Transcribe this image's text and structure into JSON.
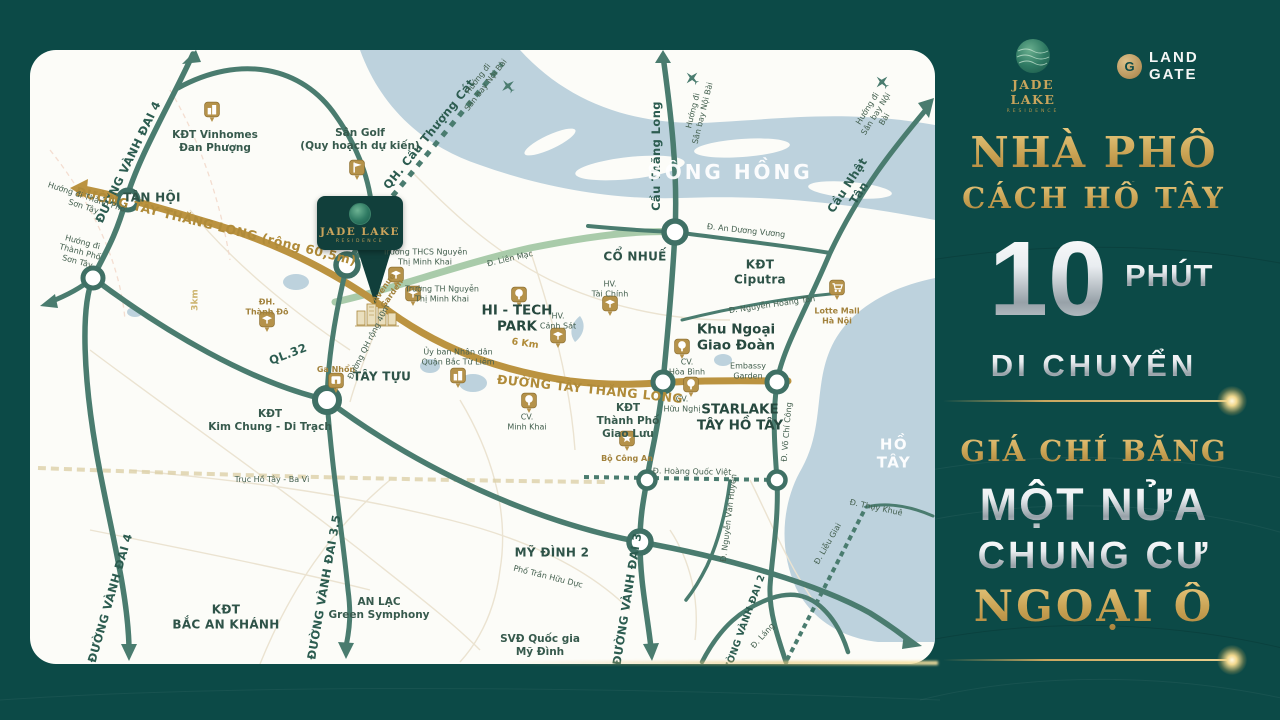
{
  "panel": {
    "jade_lake": {
      "title": "JADE LAKE",
      "subtitle": "RESIDENCE"
    },
    "land_gate": {
      "line1": "LAND",
      "line2": "GATE"
    },
    "headline_line1": "NHÀ PHỐ",
    "headline_line2": "CÁCH HỒ TÂY",
    "big_number": "10",
    "big_number_unit": "PHÚT",
    "headline_line3": "DI CHUYỂN",
    "sub_line1": "GIÁ CHỈ BẰNG",
    "sub_line2": "MỘT NỬA",
    "sub_line3": "CHUNG CƯ",
    "sub_line4": "NGOẠI Ô",
    "colors": {
      "background": "#0c4a47",
      "gold": "#c8a45c",
      "silver": "#e6ebee"
    }
  },
  "map": {
    "pin": {
      "title": "JADE LAKE",
      "subtitle": "RESIDENCE"
    },
    "colors": {
      "water": "#bdd2dd",
      "road_green": "#4a7c6f",
      "road_gold": "#bb9340",
      "road_light_green": "#a9cbaa"
    },
    "labels": [
      {
        "name": "road-vanh-dai-4-north",
        "text": "ĐƯỜNG VÀNH ĐAI 4",
        "x": 98,
        "y": 112,
        "rot": -64,
        "cls": "l-road"
      },
      {
        "name": "road-vanh-dai-4-south",
        "text": "ĐƯỜNG VÀNH ĐAI 4",
        "x": 80,
        "y": 548,
        "rot": -74,
        "cls": "l-road"
      },
      {
        "name": "road-vanh-dai-3-5",
        "text": "ĐƯỜNG VÀNH ĐAI 3.5",
        "x": 294,
        "y": 537,
        "rot": -80,
        "cls": "l-road"
      },
      {
        "name": "road-vanh-dai-3",
        "text": "ĐƯỜNG VÀNH ĐAI 3",
        "x": 597,
        "y": 549,
        "rot": -81,
        "cls": "l-road"
      },
      {
        "name": "road-vanh-dai-2",
        "text": "ĐƯỜNG VÀNH ĐAI 2",
        "x": 714,
        "y": 577,
        "rot": -70,
        "cls": "l-road-sm"
      },
      {
        "name": "road-ql-32",
        "text": "QL.32",
        "x": 258,
        "y": 304,
        "rot": -21,
        "cls": "l-road"
      },
      {
        "name": "road-cau-thang-long",
        "text": "Cầu Thăng Long",
        "x": 626,
        "y": 106,
        "rot": -90,
        "cls": "l-road"
      },
      {
        "name": "road-cau-nhat-tan",
        "text": "Cầu Nhật Tân",
        "x": 823,
        "y": 139,
        "rot": -57,
        "cls": "l-road"
      },
      {
        "name": "road-qh-cau-thuong-cat",
        "text": "QH. Cầu Thượng Cát",
        "x": 399,
        "y": 84,
        "rot": -51,
        "cls": "l-road"
      },
      {
        "name": "road-tay-thang-long-west",
        "text": "ĐƯỜNG TÂY THĂNG LONG (rộng 60,5m)",
        "x": 186,
        "y": 176,
        "rot": 14,
        "cls": "l-gold"
      },
      {
        "name": "road-tay-thang-long-east",
        "text": "ĐƯỜNG TÂY THĂNG LONG",
        "x": 560,
        "y": 339,
        "rot": 6,
        "cls": "l-gold"
      },
      {
        "name": "distance-6km",
        "text": "6 Km",
        "x": 495,
        "y": 294,
        "rot": 8,
        "cls": "l-gold-sm"
      },
      {
        "name": "distance-3km",
        "text": "3km",
        "x": 166,
        "y": 250,
        "rot": -90,
        "cls": "l-faint-g"
      },
      {
        "name": "road-truc-ho-tay-ba-vi",
        "text": "Trục Hồ Tây - Ba Vì",
        "x": 242,
        "y": 430,
        "rot": 0,
        "cls": "l-tiny"
      },
      {
        "name": "area-tan-hoi",
        "text": "TÂN HỘI",
        "x": 122,
        "y": 148,
        "rot": 0,
        "cls": "l-area"
      },
      {
        "name": "area-tay-tuu",
        "text": "TÂY TỰU",
        "x": 352,
        "y": 327,
        "rot": 0,
        "cls": "l-area"
      },
      {
        "name": "area-co-nhue",
        "text": "CỔ NHUẾ",
        "x": 605,
        "y": 207,
        "rot": 0,
        "cls": "l-area"
      },
      {
        "name": "area-my-dinh-2",
        "text": "MỸ ĐÌNH 2",
        "x": 522,
        "y": 503,
        "rot": 0,
        "cls": "l-area"
      },
      {
        "name": "area-kdt-vinhomes-dan-phuong",
        "text": "KĐT Vinhomes\nĐan Phượng",
        "x": 185,
        "y": 92,
        "rot": 0,
        "cls": "l-kdt"
      },
      {
        "name": "area-kdt-kim-chung-di-trach",
        "text": "KĐT\nKim Chung - Di Trạch",
        "x": 240,
        "y": 371,
        "rot": 0,
        "cls": "l-kdt"
      },
      {
        "name": "area-kdt-bac-an-khanh",
        "text": "KĐT\nBẮC AN KHÁNH",
        "x": 196,
        "y": 567,
        "rot": 0,
        "cls": "l-area"
      },
      {
        "name": "area-an-lac-green-symphony",
        "text": "AN LẠC\nGreen Symphony",
        "x": 349,
        "y": 559,
        "rot": 0,
        "cls": "l-kdt"
      },
      {
        "name": "area-kdt-thanh-pho-giao-luu",
        "text": "KĐT\nThành Phố\nGiao Lưu",
        "x": 598,
        "y": 371,
        "rot": 0,
        "cls": "l-kdt"
      },
      {
        "name": "area-kdt-ciputra",
        "text": "KĐT\nCiputra",
        "x": 730,
        "y": 222,
        "rot": 0,
        "cls": "l-area"
      },
      {
        "name": "area-khu-ngoai-giao-doan",
        "text": "Khu Ngoại\nGiao Đoàn",
        "x": 706,
        "y": 288,
        "rot": 0,
        "cls": "l-area-lg"
      },
      {
        "name": "area-starlake-tay-ho-tay",
        "text": "STARLAKE\nTÂY HỒ TÂY",
        "x": 710,
        "y": 368,
        "rot": 0,
        "cls": "l-area-lg"
      },
      {
        "name": "area-hi-tech-park",
        "text": "HI - TECH\nPARK",
        "x": 487,
        "y": 269,
        "rot": 0,
        "cls": "l-area-lg"
      },
      {
        "name": "poi-svd-quoc-gia-my-dinh",
        "text": "SVĐ Quốc gia\nMỹ Đình",
        "x": 510,
        "y": 596,
        "rot": 0,
        "cls": "l-kdt"
      },
      {
        "name": "poi-san-golf",
        "text": "Sân Golf\n(Quy hoạch dự kiến)",
        "x": 330,
        "y": 90,
        "rot": 0,
        "cls": "l-kdt"
      },
      {
        "name": "water-song-hong",
        "text": "SÔNG HỒNG",
        "x": 700,
        "y": 122,
        "rot": 0,
        "cls": "l-water"
      },
      {
        "name": "water-ho-tay",
        "text": "HỒ TÂY",
        "x": 864,
        "y": 404,
        "rot": 0,
        "cls": "l-water-sm"
      },
      {
        "name": "poi-truong-thcs-nguyen-thi-minh-khai",
        "text": "Trường THCS Nguyễn\nThị Minh Khai",
        "x": 395,
        "y": 207,
        "rot": 0,
        "cls": "l-tiny"
      },
      {
        "name": "poi-truong-th-nguyen-thi-minh-khai",
        "text": "Trường TH Nguyễn\nThị Minh Khai",
        "x": 412,
        "y": 244,
        "rot": 0,
        "cls": "l-tiny"
      },
      {
        "name": "poi-uy-ban-nhan-dan",
        "text": "Ủy ban Nhân dân\nQuận Bắc Từ Liêm",
        "x": 428,
        "y": 307,
        "rot": 0,
        "cls": "l-tiny"
      },
      {
        "name": "poi-cv-minh-khai",
        "text": "CV.\nMinh Khai",
        "x": 497,
        "y": 372,
        "rot": 0,
        "cls": "l-tiny"
      },
      {
        "name": "poi-cv-hoa-binh",
        "text": "CV.\nHòa Bình",
        "x": 657,
        "y": 317,
        "rot": 0,
        "cls": "l-tiny"
      },
      {
        "name": "poi-cv-huu-nghi",
        "text": "CV.\nHữu Nghị",
        "x": 652,
        "y": 354,
        "rot": 0,
        "cls": "l-tiny"
      },
      {
        "name": "poi-embassy-garden",
        "text": "Embassy\nGarden",
        "x": 718,
        "y": 321,
        "rot": 0,
        "cls": "l-tiny"
      },
      {
        "name": "poi-hv-canh-sat",
        "text": "HV.\nCảnh Sát",
        "x": 528,
        "y": 271,
        "rot": 0,
        "cls": "l-tiny"
      },
      {
        "name": "poi-hv-tai-chinh",
        "text": "HV.\nTài Chính",
        "x": 580,
        "y": 239,
        "rot": 0,
        "cls": "l-tiny"
      },
      {
        "name": "poi-bo-cong-an",
        "text": "Bộ Công An",
        "x": 597,
        "y": 409,
        "rot": 0,
        "cls": "l-tiny-g"
      },
      {
        "name": "poi-lotte-mall",
        "text": "Lotte Mall\nHà Nội",
        "x": 807,
        "y": 266,
        "rot": 0,
        "cls": "l-tiny-g"
      },
      {
        "name": "poi-ga-nhon",
        "text": "Ga Nhổn",
        "x": 306,
        "y": 320,
        "rot": 0,
        "cls": "l-tiny-g"
      },
      {
        "name": "poi-dh-thanh-do",
        "text": "ĐH.\nThành Đô",
        "x": 237,
        "y": 257,
        "rot": 0,
        "cls": "l-tiny-g"
      },
      {
        "name": "poi-avenue-garden",
        "text": "Avenue\nGarden",
        "x": 358,
        "y": 241,
        "rot": -55,
        "cls": "l-tiny-g"
      },
      {
        "name": "road-duong-qh-rong-40m",
        "text": "Đường QH rộng 40m",
        "x": 339,
        "y": 292,
        "rot": -63,
        "cls": "l-tiny"
      },
      {
        "name": "road-lien-mac",
        "text": "Đ. Liên Mạc",
        "x": 480,
        "y": 209,
        "rot": -13,
        "cls": "l-tiny"
      },
      {
        "name": "road-an-duong-vuong",
        "text": "Đ. An Dương Vương",
        "x": 716,
        "y": 181,
        "rot": 6,
        "cls": "l-tiny"
      },
      {
        "name": "road-nguyen-hoang-ton",
        "text": "Đ. Nguyễn Hoàng Tôn",
        "x": 742,
        "y": 255,
        "rot": -8,
        "cls": "l-tiny"
      },
      {
        "name": "road-hoang-quoc-viet",
        "text": "Đ. Hoàng Quốc Việt",
        "x": 662,
        "y": 422,
        "rot": 1,
        "cls": "l-tiny"
      },
      {
        "name": "road-vo-chi-cong",
        "text": "Đ. Võ Chí Công",
        "x": 757,
        "y": 382,
        "rot": -85,
        "cls": "l-tiny"
      },
      {
        "name": "road-nguyen-van-huyen",
        "text": "Đ. Nguyễn Văn Huyên",
        "x": 699,
        "y": 468,
        "rot": -83,
        "cls": "l-tiny"
      },
      {
        "name": "road-lang",
        "text": "Đ. Láng",
        "x": 733,
        "y": 586,
        "rot": -48,
        "cls": "l-tiny"
      },
      {
        "name": "road-lieu-giai",
        "text": "Đ. Liễu Giai",
        "x": 798,
        "y": 494,
        "rot": -60,
        "cls": "l-tiny"
      },
      {
        "name": "road-thuy-khue",
        "text": "Đ. Thụy Khuê",
        "x": 846,
        "y": 458,
        "rot": 12,
        "cls": "l-tiny"
      },
      {
        "name": "road-pho-tran-huu-duc",
        "text": "Phố Trần Hữu Dực",
        "x": 518,
        "y": 527,
        "rot": 14,
        "cls": "l-tiny"
      },
      {
        "name": "hint-son-tay-1",
        "text": "Hướng đi Thành Phố\nSơn Tây",
        "x": 55,
        "y": 152,
        "rot": 18,
        "cls": "l-tiny"
      },
      {
        "name": "hint-son-tay-2",
        "text": "Hướng đi\nThành Phố\nSơn Tây",
        "x": 50,
        "y": 202,
        "rot": 15,
        "cls": "l-tiny"
      },
      {
        "name": "hint-noi-bai-1",
        "text": "Hướng đi\nSân bay Nội Bài",
        "x": 452,
        "y": 32,
        "rot": -52,
        "cls": "l-tiny"
      },
      {
        "name": "hint-noi-bai-2",
        "text": "Hướng đi\nSân bay Nội Bài",
        "x": 668,
        "y": 62,
        "rot": -76,
        "cls": "l-tiny"
      },
      {
        "name": "hint-noi-bai-3",
        "text": "Hướng đi\nSân bay Nội Bài",
        "x": 846,
        "y": 64,
        "rot": -58,
        "cls": "l-tiny"
      }
    ],
    "icons": [
      {
        "type": "building",
        "name": "vinhomes-building-icon",
        "x": 182,
        "y": 62
      },
      {
        "type": "flag",
        "name": "golf-flag-icon",
        "x": 327,
        "y": 120
      },
      {
        "type": "school",
        "name": "thcs-school-icon",
        "x": 366,
        "y": 227
      },
      {
        "type": "school",
        "name": "th-school-icon",
        "x": 383,
        "y": 246
      },
      {
        "type": "building",
        "name": "ubnd-building-icon",
        "x": 428,
        "y": 328
      },
      {
        "type": "tree",
        "name": "hi-tech-park-tree-icon",
        "x": 489,
        "y": 247
      },
      {
        "type": "school",
        "name": "hv-canh-sat-icon",
        "x": 528,
        "y": 288
      },
      {
        "type": "school",
        "name": "hv-tai-chinh-icon",
        "x": 580,
        "y": 256
      },
      {
        "type": "tree",
        "name": "cv-minh-khai-tree-icon",
        "x": 499,
        "y": 353
      },
      {
        "type": "tree",
        "name": "cv-hoa-binh-tree-icon",
        "x": 652,
        "y": 299
      },
      {
        "type": "tree",
        "name": "cv-huu-nghi-tree-icon",
        "x": 661,
        "y": 337
      },
      {
        "type": "star",
        "name": "bo-cong-an-badge-icon",
        "x": 597,
        "y": 391
      },
      {
        "type": "cart",
        "name": "lotte-mall-cart-icon",
        "x": 807,
        "y": 240
      },
      {
        "type": "station",
        "name": "ga-nhon-station-icon",
        "x": 306,
        "y": 333
      },
      {
        "type": "school",
        "name": "dh-thanh-do-icon",
        "x": 237,
        "y": 272
      },
      {
        "type": "plane",
        "name": "airplane-icon",
        "x": 478,
        "y": 36,
        "rot": -40
      },
      {
        "type": "plane",
        "name": "airplane-icon",
        "x": 662,
        "y": 28,
        "rot": -45
      },
      {
        "type": "plane",
        "name": "airplane-icon",
        "x": 852,
        "y": 32,
        "rot": -45
      },
      {
        "type": "complex",
        "name": "avenue-garden-buildings-icon",
        "x": 347,
        "y": 263
      }
    ]
  }
}
